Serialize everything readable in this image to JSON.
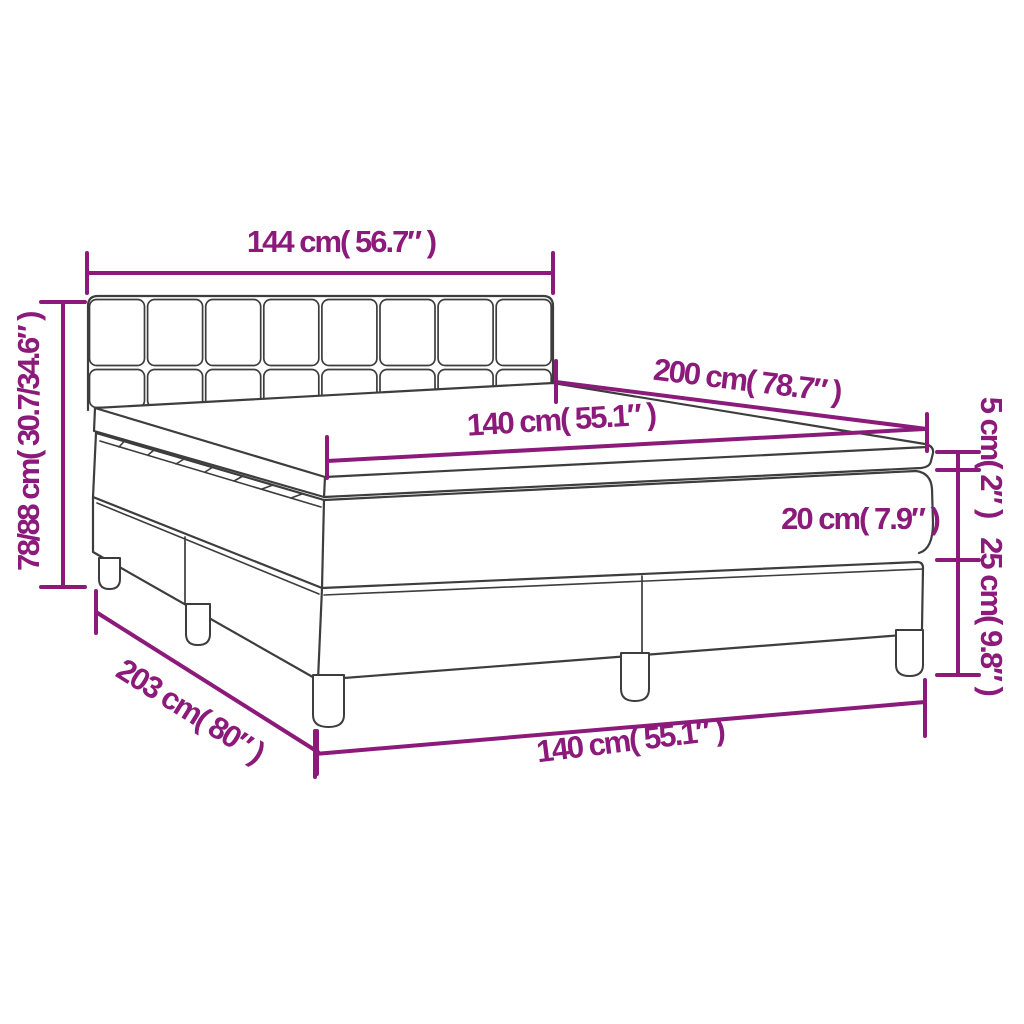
{
  "diagram": {
    "type": "product-dimension-diagram",
    "product": "box spring bed with headboard, mattress and topper",
    "labels": {
      "headboard_width": "144 cm( 56.7″ )",
      "total_height": "78/88 cm( 30.7/34.6″ )",
      "length": "200 cm( 78.7″ )",
      "mattress_width": "140 cm( 55.1″ )",
      "topper_thickness": "5 cm( 2″ )",
      "mattress_thickness": "20 cm( 7.9″ )",
      "base_height": "25 cm( 9.8″ )",
      "base_width": "140 cm( 55.1″ )",
      "base_length": "203 cm( 80″ )"
    },
    "colors": {
      "dimension_lines": "#8B1A7A",
      "drawing_outline": "#3D3D3D",
      "background": "#FFFFFF"
    }
  }
}
